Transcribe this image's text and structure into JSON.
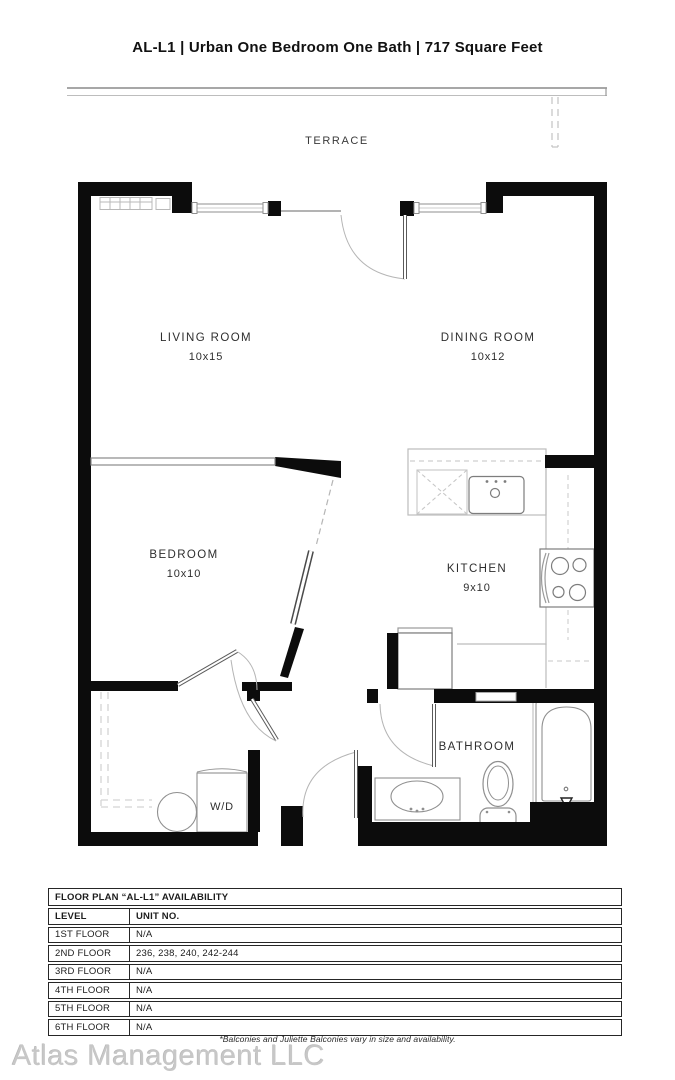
{
  "title": "AL-L1 | Urban One Bedroom One Bath | 717 Square Feet",
  "plan": {
    "terrace_label": "TERRACE",
    "rooms": [
      {
        "name": "LIVING ROOM",
        "dims": "10x15"
      },
      {
        "name": "DINING ROOM",
        "dims": "10x12"
      },
      {
        "name": "BEDROOM",
        "dims": "10x10"
      },
      {
        "name": "KITCHEN",
        "dims": "9x10"
      },
      {
        "name": "BATHROOM",
        "dims": ""
      },
      {
        "name": "W/D",
        "dims": ""
      }
    ],
    "fixtures": [
      "kitchen-sink",
      "dishwasher",
      "stove",
      "refrigerator",
      "bathtub",
      "toilet",
      "vanity-sink",
      "washer-dryer",
      "laundry-basket",
      "baseboard-heater",
      "closet-rod"
    ]
  },
  "availability_table": {
    "title": "FLOOR PLAN “AL-L1” AVAILABILITY",
    "columns": [
      "LEVEL",
      "UNIT NO."
    ],
    "rows": [
      {
        "level": "1ST FLOOR",
        "unit_no": "N/A"
      },
      {
        "level": "2ND FLOOR",
        "unit_no": "236, 238, 240, 242-244"
      },
      {
        "level": "3RD FLOOR",
        "unit_no": "N/A"
      },
      {
        "level": "4TH FLOOR",
        "unit_no": "N/A"
      },
      {
        "level": "5TH FLOOR",
        "unit_no": "N/A"
      },
      {
        "level": "6TH FLOOR",
        "unit_no": "N/A"
      }
    ]
  },
  "footnote": "*Balconies and Juliette Balconies vary in size and availability.",
  "watermark": "Atlas Management LLC",
  "colors": {
    "wall": "#0c0c0c",
    "fixture_line": "#8f8f8f",
    "light_line": "#c0c0c0",
    "text": "#2e2e2e"
  }
}
